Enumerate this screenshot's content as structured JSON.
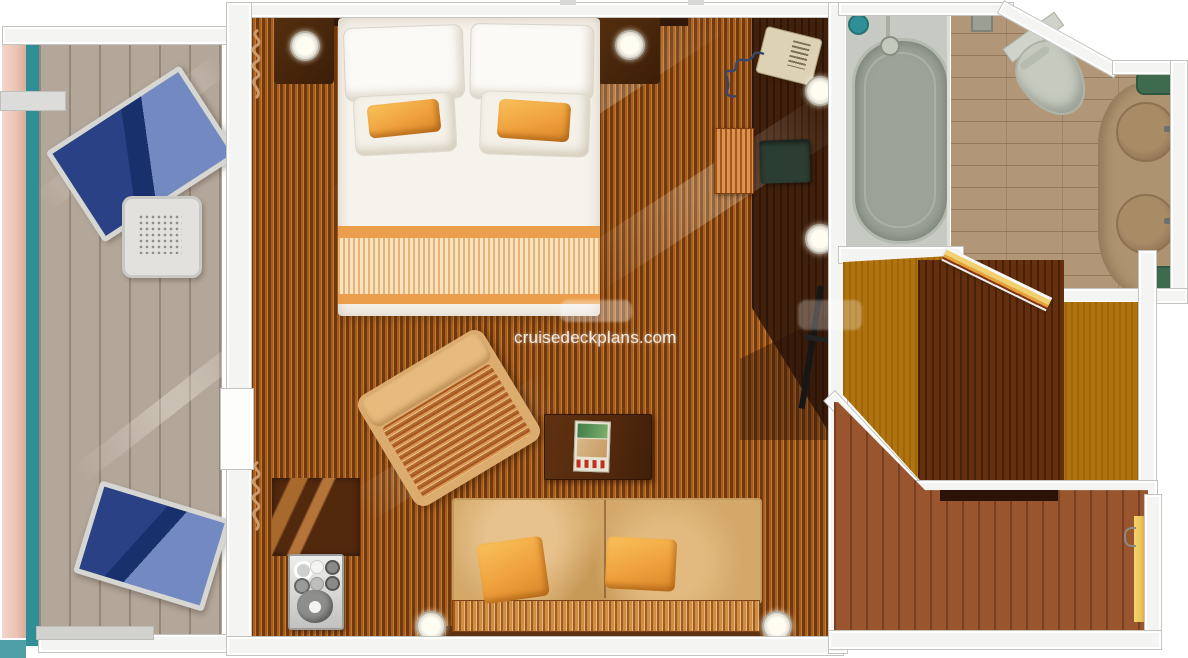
{
  "title": "Cruise ship suite cabin floor plan (top-down rendering)",
  "watermark": {
    "text": "cruisedeckplans.com",
    "color": "#ffffff"
  },
  "palette": {
    "wall": "#f4f4f2",
    "wall_border": "#c3c3c0",
    "carpet_dark": "#6e3a10",
    "carpet_mid": "#a85c1d",
    "carpet_light": "#c27a33",
    "wood_dark": "#42210c",
    "deck": "#b3a79a",
    "teal": "#2f8e96",
    "hull_pink": "#eac4b5",
    "lounger_navy": "#2a4185",
    "lounger_light": "#7289c2",
    "bed_white": "#f6f3ec",
    "bed_band": "#eb9f4d",
    "accent_orange": "#efa13d",
    "sofa_tan": "#d3a869",
    "stripe_dark": "#a15a22",
    "stripe_light": "#cf8f42",
    "armchair_tan": "#dcab6e",
    "table_wood": "#53290e",
    "tub_surround": "#c6cac2",
    "tub_fill": "#9da398",
    "bath_floor": "#b19778",
    "counter": "#ae9370",
    "sink": "#a78c66",
    "mat_green": "#3e6b4e",
    "toilet": "#c6cabf",
    "closet_amber": "#b0740f",
    "closet_brown": "#66300f",
    "entry_wood": "#99552e",
    "threshold": "#2a1206",
    "door_yellow": "#eec45a",
    "phone_beige": "#ddd2b6",
    "green_chair": "#2c3d33",
    "tv_black": "#161616",
    "lamp": "#fffdf2"
  },
  "rooms": {
    "balcony": {
      "elements": [
        "lounge-chair",
        "lounge-chair",
        "perforated-side-table",
        "deck-planks",
        "railing"
      ]
    },
    "bedroom_living": {
      "elements": [
        "king-bed",
        "white-pillows",
        "orange-throw-pillows",
        "nightstand-left",
        "nightstand-right",
        "ceiling-lamps",
        "curtains",
        "armchair",
        "coffee-table-with-magazine",
        "sofa",
        "minibar-cabinet",
        "drink-tray",
        "ottoman",
        "desk-chair",
        "telephone",
        "tv"
      ]
    },
    "bathroom": {
      "elements": [
        "bathtub",
        "shower-head",
        "toilet",
        "double-sink-vanity",
        "bath-mats"
      ]
    },
    "closet": {
      "elements": [
        "wood-floor",
        "wardrobe-carpet",
        "folding-door"
      ]
    },
    "entry": {
      "elements": [
        "wood-floor",
        "door-thresholds",
        "yellow-door"
      ]
    }
  }
}
